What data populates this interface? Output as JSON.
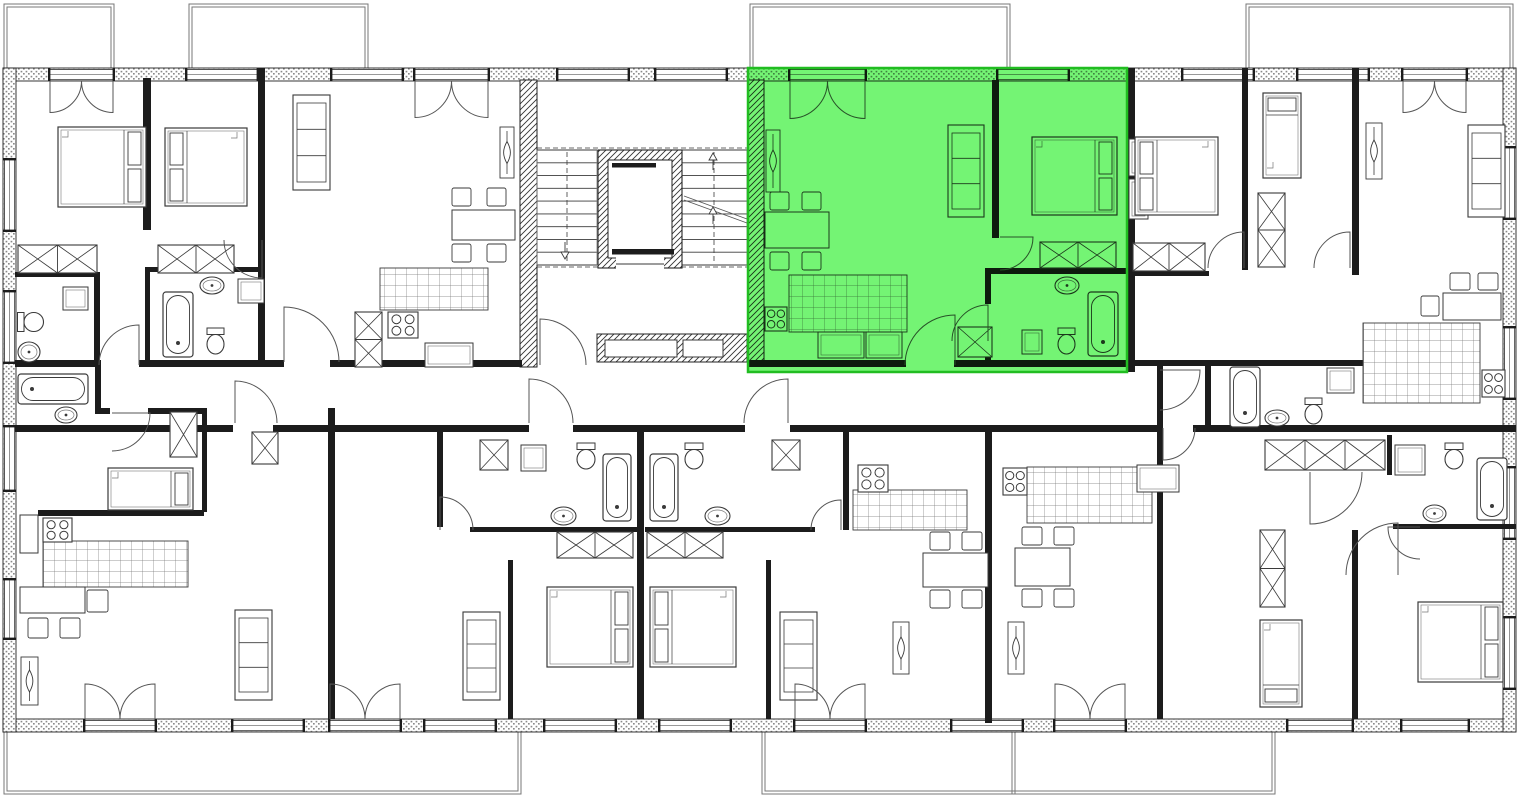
{
  "meta": {
    "aria_label": "Residential building floor plan with one apartment highlighted in green",
    "canvas": {
      "w": 1519,
      "h": 800
    }
  },
  "colors": {
    "line": "#1c1c1c",
    "thin": "#555555",
    "mid": "#777777",
    "furn": "#3a3a3a",
    "white": "#ffffff",
    "green_fill": "#3ff03f",
    "green_opacity": 0.72,
    "green_border": "#21bd21"
  },
  "highlight": {
    "x": 748,
    "y": 68,
    "w": 379,
    "h": 304
  },
  "plan": {
    "bands": [
      [
        3,
        68,
        1513,
        13
      ],
      [
        3,
        719,
        1513,
        13
      ],
      [
        3,
        68,
        13,
        664
      ],
      [
        1503,
        68,
        13,
        664
      ]
    ],
    "walls": [
      [
        143,
        78,
        8,
        152
      ],
      [
        258,
        68,
        7,
        299
      ],
      [
        15,
        272,
        82,
        5
      ],
      [
        94,
        272,
        6,
        95
      ],
      [
        145,
        267,
        119,
        5
      ],
      [
        145,
        272,
        5,
        90
      ],
      [
        15,
        360,
        86,
        7
      ],
      [
        139,
        360,
        145,
        7
      ],
      [
        330,
        360,
        192,
        7
      ],
      [
        748,
        360,
        158,
        7
      ],
      [
        954,
        360,
        173,
        7
      ],
      [
        992,
        80,
        7,
        158
      ],
      [
        985,
        268,
        142,
        6
      ],
      [
        985,
        274,
        6,
        30
      ],
      [
        985,
        336,
        6,
        26
      ],
      [
        1127,
        68,
        8,
        304
      ],
      [
        1242,
        68,
        6,
        202
      ],
      [
        1352,
        68,
        7,
        207
      ],
      [
        1127,
        271,
        82,
        5
      ],
      [
        1135,
        360,
        75,
        6
      ],
      [
        1205,
        360,
        162,
        6
      ],
      [
        1205,
        366,
        6,
        59
      ],
      [
        1157,
        366,
        6,
        59
      ],
      [
        15,
        425,
        218,
        7
      ],
      [
        273,
        425,
        256,
        7
      ],
      [
        573,
        425,
        172,
        7
      ],
      [
        790,
        425,
        373,
        7
      ],
      [
        1193,
        425,
        77,
        7
      ],
      [
        1270,
        425,
        246,
        7
      ],
      [
        95,
        362,
        6,
        50
      ],
      [
        95,
        408,
        15,
        6
      ],
      [
        148,
        408,
        59,
        6
      ],
      [
        202,
        408,
        5,
        104
      ],
      [
        38,
        510,
        166,
        6
      ],
      [
        205,
        425,
        28,
        7
      ],
      [
        328,
        408,
        7,
        311
      ],
      [
        437,
        430,
        6,
        97
      ],
      [
        470,
        527,
        170,
        5
      ],
      [
        508,
        560,
        5,
        159
      ],
      [
        637,
        430,
        7,
        289
      ],
      [
        645,
        527,
        170,
        5
      ],
      [
        766,
        560,
        5,
        159
      ],
      [
        843,
        430,
        6,
        100
      ],
      [
        985,
        430,
        7,
        293
      ],
      [
        1157,
        430,
        6,
        289
      ],
      [
        1352,
        530,
        6,
        189
      ],
      [
        1393,
        524,
        123,
        5
      ],
      [
        1387,
        435,
        5,
        40
      ]
    ],
    "hwalls": [
      [
        520,
        80,
        17,
        287
      ],
      [
        748,
        80,
        16,
        282
      ],
      [
        597,
        334,
        150,
        28
      ]
    ],
    "boxes": [
      [
        605,
        340,
        72,
        17
      ],
      [
        683,
        340,
        40,
        17
      ],
      [
        20,
        515,
        18,
        38
      ]
    ],
    "ducts": [
      [
        1129,
        139,
        19,
        37
      ],
      [
        1129,
        179,
        19,
        40
      ]
    ],
    "windows": {
      "top": [
        [
          50,
          113
        ],
        [
          187,
          257
        ],
        [
          332,
          402
        ],
        [
          415,
          488
        ],
        [
          558,
          628
        ],
        [
          656,
          726
        ],
        [
          790,
          865
        ],
        [
          998,
          1068
        ],
        [
          1183,
          1253
        ],
        [
          1298,
          1368
        ],
        [
          1403,
          1466
        ]
      ],
      "bottom": [
        [
          85,
          155
        ],
        [
          233,
          303
        ],
        [
          330,
          400
        ],
        [
          425,
          495
        ],
        [
          545,
          615
        ],
        [
          660,
          730
        ],
        [
          795,
          865
        ],
        [
          952,
          1022
        ],
        [
          1055,
          1125
        ],
        [
          1288,
          1352
        ],
        [
          1402,
          1468
        ]
      ],
      "left": [
        [
          160,
          230
        ],
        [
          292,
          362
        ],
        [
          427,
          490
        ],
        [
          580,
          638
        ]
      ],
      "right": [
        [
          148,
          218
        ],
        [
          328,
          398
        ],
        [
          468,
          538
        ],
        [
          618,
          688
        ]
      ]
    },
    "balconies": {
      "top": [
        [
          4,
          4,
          110,
          64
        ],
        [
          189,
          4,
          179,
          64
        ],
        [
          750,
          4,
          260,
          64
        ],
        [
          1246,
          4,
          267,
          64
        ]
      ],
      "bottom": [
        [
          4,
          732,
          517,
          62
        ],
        [
          762,
          732,
          513,
          62
        ]
      ],
      "dividers": [
        [
          1012,
          732,
          1012,
          794
        ]
      ]
    },
    "french": [
      [
        50,
        81,
        63,
        1
      ],
      [
        415,
        81,
        73,
        1
      ],
      [
        790,
        81,
        75,
        1
      ],
      [
        1403,
        81,
        63,
        1
      ],
      [
        85,
        719,
        70,
        -1
      ],
      [
        330,
        719,
        70,
        -1
      ],
      [
        795,
        719,
        70,
        -1
      ],
      [
        1055,
        719,
        70,
        -1
      ]
    ],
    "doors": [
      [
        955,
        365,
        50,
        270,
        180
      ],
      [
        1000,
        237,
        33,
        0,
        90
      ],
      [
        988,
        341,
        36,
        270,
        180
      ],
      [
        284,
        362,
        55,
        270,
        0
      ],
      [
        139,
        365,
        40,
        270,
        180
      ],
      [
        262,
        240,
        38,
        90,
        180
      ],
      [
        235,
        423,
        42,
        270,
        0
      ],
      [
        529,
        423,
        44,
        270,
        0
      ],
      [
        788,
        423,
        44,
        270,
        180
      ],
      [
        1163,
        428,
        32,
        90,
        0
      ],
      [
        540,
        365,
        46,
        270,
        0
      ],
      [
        1244,
        268,
        36,
        270,
        180
      ],
      [
        1350,
        268,
        36,
        270,
        180
      ],
      [
        1160,
        370,
        40,
        0,
        90
      ],
      [
        440,
        530,
        33,
        270,
        0
      ],
      [
        841,
        530,
        30,
        270,
        180
      ],
      [
        112,
        413,
        38,
        0,
        90
      ],
      [
        1310,
        472,
        52,
        90,
        0
      ],
      [
        1398,
        575,
        52,
        270,
        180
      ],
      [
        1420,
        527,
        32,
        180,
        90
      ]
    ],
    "beds": [
      [
        58,
        127,
        88,
        80,
        "E"
      ],
      [
        165,
        128,
        82,
        78,
        "W"
      ],
      [
        1032,
        137,
        85,
        78,
        "E"
      ],
      [
        1135,
        137,
        83,
        78,
        "W"
      ],
      [
        547,
        587,
        86,
        80,
        "E"
      ],
      [
        650,
        587,
        86,
        80,
        "W"
      ],
      [
        1418,
        602,
        85,
        80,
        "E"
      ],
      [
        1263,
        93,
        38,
        85,
        "N"
      ],
      [
        108,
        468,
        85,
        42,
        "E"
      ],
      [
        1260,
        620,
        42,
        87,
        "S"
      ]
    ],
    "wardrobes": [
      [
        18,
        245,
        79,
        28
      ],
      [
        158,
        245,
        76,
        28
      ],
      [
        1040,
        242,
        76,
        26
      ],
      [
        1133,
        243,
        72,
        28
      ],
      [
        557,
        532,
        76,
        26
      ],
      [
        647,
        532,
        76,
        26
      ],
      [
        1258,
        193,
        27,
        74
      ],
      [
        170,
        412,
        27,
        45
      ],
      [
        480,
        440,
        28,
        30
      ],
      [
        772,
        440,
        28,
        30
      ],
      [
        958,
        327,
        34,
        30
      ],
      [
        252,
        432,
        26,
        32
      ],
      [
        355,
        312,
        27,
        55
      ],
      [
        1265,
        440,
        120,
        30
      ],
      [
        1260,
        530,
        25,
        77
      ]
    ],
    "sofas": [
      [
        293,
        95,
        37,
        95
      ],
      [
        948,
        125,
        36,
        92
      ],
      [
        1468,
        125,
        37,
        92
      ],
      [
        463,
        612,
        37,
        88
      ],
      [
        780,
        612,
        37,
        88
      ],
      [
        235,
        610,
        37,
        90
      ]
    ],
    "tables": [
      [
        452,
        210,
        63,
        30
      ],
      [
        765,
        212,
        64,
        36
      ],
      [
        1443,
        293,
        58,
        27
      ],
      [
        20,
        587,
        65,
        26
      ],
      [
        923,
        553,
        65,
        34
      ],
      [
        1015,
        548,
        55,
        38
      ]
    ],
    "chairs": [
      [
        452,
        188,
        19,
        18
      ],
      [
        487,
        188,
        19,
        18
      ],
      [
        452,
        244,
        19,
        18
      ],
      [
        487,
        244,
        19,
        18
      ],
      [
        770,
        192,
        19,
        18
      ],
      [
        802,
        192,
        19,
        18
      ],
      [
        770,
        252,
        19,
        18
      ],
      [
        802,
        252,
        19,
        18
      ],
      [
        1450,
        273,
        20,
        17
      ],
      [
        1478,
        273,
        20,
        17
      ],
      [
        1421,
        296,
        18,
        20
      ],
      [
        87,
        590,
        21,
        22
      ],
      [
        28,
        618,
        20,
        20
      ],
      [
        60,
        618,
        20,
        20
      ],
      [
        930,
        532,
        20,
        18
      ],
      [
        962,
        532,
        20,
        18
      ],
      [
        930,
        590,
        20,
        18
      ],
      [
        962,
        590,
        20,
        18
      ],
      [
        1022,
        527,
        20,
        18
      ],
      [
        1054,
        527,
        20,
        18
      ],
      [
        1022,
        589,
        20,
        18
      ],
      [
        1054,
        589,
        20,
        18
      ]
    ],
    "kitchens": [
      [
        380,
        268,
        108,
        42
      ],
      [
        789,
        275,
        118,
        57
      ],
      [
        1363,
        323,
        117,
        80
      ],
      [
        43,
        541,
        145,
        46
      ],
      [
        853,
        490,
        114,
        40
      ],
      [
        1027,
        467,
        125,
        56
      ]
    ],
    "stoves": [
      [
        388,
        312,
        30,
        26
      ],
      [
        765,
        307,
        22,
        24
      ],
      [
        1482,
        370,
        23,
        27
      ],
      [
        43,
        518,
        29,
        24
      ],
      [
        858,
        465,
        30,
        27
      ],
      [
        1003,
        468,
        24,
        27
      ]
    ],
    "sinks": [
      [
        18,
        342,
        22,
        20
      ],
      [
        200,
        277,
        24,
        17
      ],
      [
        1055,
        277,
        24,
        17
      ],
      [
        551,
        507,
        25,
        18
      ],
      [
        705,
        507,
        25,
        18
      ],
      [
        1265,
        410,
        24,
        16
      ],
      [
        55,
        407,
        22,
        16
      ],
      [
        1423,
        505,
        23,
        17
      ]
    ],
    "toilets": [
      [
        207,
        328,
        17,
        28,
        0
      ],
      [
        1058,
        328,
        17,
        28,
        0
      ],
      [
        577,
        443,
        18,
        28,
        0
      ],
      [
        685,
        443,
        18,
        28,
        0
      ],
      [
        1305,
        398,
        17,
        28,
        0
      ],
      [
        1445,
        443,
        18,
        28,
        0
      ],
      [
        22,
        308,
        19,
        28,
        270
      ]
    ],
    "tubs": [
      [
        163,
        292,
        30,
        65
      ],
      [
        1088,
        292,
        30,
        64
      ],
      [
        18,
        374,
        70,
        30
      ],
      [
        603,
        454,
        28,
        67
      ],
      [
        650,
        454,
        28,
        67
      ],
      [
        1230,
        367,
        30,
        60
      ],
      [
        1477,
        458,
        30,
        62
      ]
    ],
    "radiators": [
      [
        500,
        127,
        14,
        51
      ],
      [
        766,
        130,
        14,
        62
      ],
      [
        893,
        622,
        16,
        52
      ],
      [
        1008,
        622,
        16,
        52
      ],
      [
        1366,
        123,
        16,
        56
      ],
      [
        21,
        657,
        17,
        48
      ]
    ],
    "shelves": [
      [
        63,
        287,
        25,
        23
      ],
      [
        238,
        279,
        26,
        24
      ],
      [
        1022,
        330,
        20,
        24
      ],
      [
        521,
        445,
        25,
        26
      ],
      [
        1327,
        368,
        27,
        25
      ],
      [
        818,
        332,
        46,
        26
      ],
      [
        866,
        332,
        36,
        26
      ],
      [
        425,
        343,
        48,
        24
      ],
      [
        1137,
        465,
        42,
        27
      ],
      [
        1395,
        445,
        30,
        30
      ],
      [
        177,
        471,
        16,
        36
      ]
    ],
    "stairs": {
      "xL": 537,
      "xLe": 597,
      "xR": 682,
      "xRe": 747,
      "y1": 150,
      "y2": 265,
      "n": 9
    },
    "elevator": {
      "x": 598,
      "y": 150,
      "w": 84,
      "h": 118,
      "t": 10
    },
    "dashes": [
      [
        537,
        148,
        747,
        148
      ],
      [
        537,
        267,
        747,
        267
      ],
      [
        567,
        152,
        567,
        263
      ],
      [
        714,
        152,
        714,
        263
      ]
    ],
    "arrows": [
      [
        565,
        252,
        "down"
      ],
      [
        713,
        160,
        "up"
      ],
      [
        713,
        214,
        "up"
      ]
    ],
    "diagonals": [
      [
        684,
        196,
        747,
        219
      ],
      [
        684,
        200,
        747,
        223
      ],
      [
        188,
        541,
        155,
        587
      ]
    ]
  }
}
